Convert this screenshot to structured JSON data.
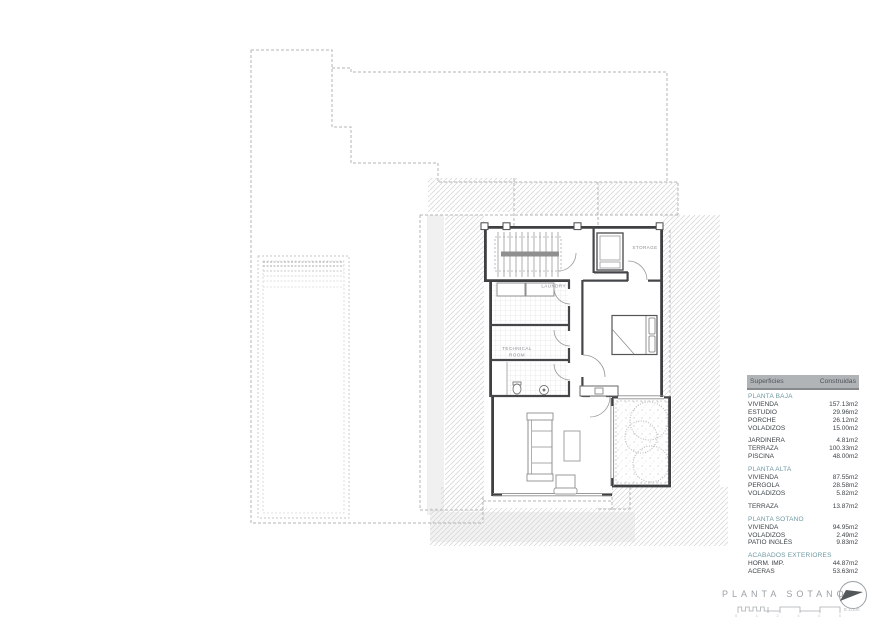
{
  "drawing": {
    "room_labels": {
      "laundry": "LAUNDRY",
      "storage": "STORAGE",
      "technical_room_line1": "TECHNICAL",
      "technical_room_line2": "ROOM"
    }
  },
  "surfaces_table": {
    "header": {
      "concept": "Superficies",
      "built": "Construidas"
    },
    "sections": [
      {
        "title": "PLANTA BAJA",
        "rows": [
          {
            "label": "VIVIENDA",
            "value": "157.13m2"
          },
          {
            "label": "ESTUDIO",
            "value": "29.96m2"
          },
          {
            "label": "PORCHE",
            "value": "26.12m2"
          },
          {
            "label": "VOLADIZOS",
            "value": "15.00m2"
          }
        ]
      },
      {
        "title": "",
        "rows": [
          {
            "label": "JARDINERA",
            "value": "4.81m2"
          },
          {
            "label": "TERRAZA",
            "value": "100.33m2"
          },
          {
            "label": "PISCINA",
            "value": "48.00m2"
          }
        ]
      },
      {
        "title": "PLANTA ALTA",
        "rows": [
          {
            "label": "VIVIENDA",
            "value": "87.55m2"
          },
          {
            "label": "PERGOLA",
            "value": "28.58m2"
          },
          {
            "label": "VOLADIZOS",
            "value": "5.82m2"
          }
        ]
      },
      {
        "title": "",
        "rows": [
          {
            "label": "TERRAZA",
            "value": "13.87m2"
          }
        ]
      },
      {
        "title": "PLANTA SOTANO",
        "rows": [
          {
            "label": "VIVIENDA",
            "value": "94.95m2"
          },
          {
            "label": "VOLADIZOS",
            "value": "2.49m2"
          },
          {
            "label": "PATIO INGLÉS",
            "value": "9.83m2"
          }
        ]
      },
      {
        "title": "ACABADOS EXTERIORES",
        "rows": [
          {
            "label": "HORM. IMP.",
            "value": "44.87m2"
          },
          {
            "label": "ACERAS",
            "value": "53.63m2"
          }
        ]
      }
    ]
  },
  "title_block": {
    "plan_title": "PLANTA SOTANO",
    "scale_text": "E 1/100",
    "scale_ticks": [
      "0",
      "1",
      "2",
      "3",
      "4",
      "5"
    ]
  },
  "colors": {
    "section_teal": "#6D98A1",
    "table_header_bg": "#B0B4B6",
    "table_text": "#3D4449",
    "muted_gray": "#9AA1A6",
    "wall_dark": "#3F4042"
  }
}
